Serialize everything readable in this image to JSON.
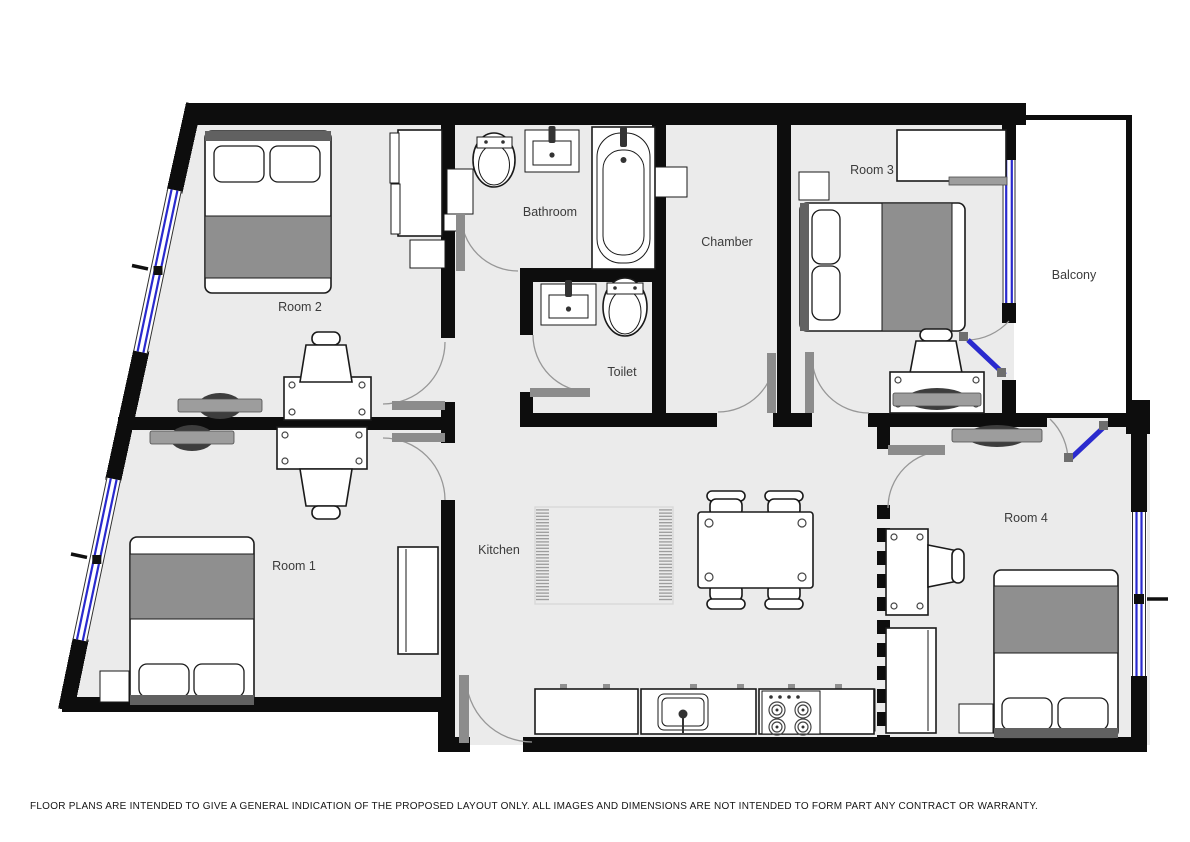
{
  "colors": {
    "floor": "#ebebeb",
    "balcony_floor": "#ffffff",
    "wall": "#0d0d0d",
    "window": "#2a2ace",
    "door_leaf": "#8c8c8c",
    "arc": "#979797",
    "blanket": "#8f8f8f",
    "headboard": "#616161",
    "tv": "#3d3d3d",
    "furniture_stroke": "#1a1a1a",
    "rug": "#d8d8d8"
  },
  "rooms": {
    "room1": {
      "label": "Room 1"
    },
    "room2": {
      "label": "Room 2"
    },
    "room3": {
      "label": "Room 3"
    },
    "room4": {
      "label": "Room 4"
    },
    "bathroom": {
      "label": "Bathroom"
    },
    "toilet": {
      "label": "Toilet"
    },
    "chamber": {
      "label": "Chamber"
    },
    "kitchen": {
      "label": "Kitchen"
    },
    "balcony": {
      "label": "Balcony"
    }
  },
  "footer": {
    "disclaimer": "FLOOR PLANS ARE INTENDED TO GIVE A GENERAL INDICATION OF THE PROPOSED LAYOUT ONLY. ALL IMAGES AND DIMENSIONS ARE NOT INTENDED TO FORM PART ANY CONTRACT OR WARRANTY."
  }
}
